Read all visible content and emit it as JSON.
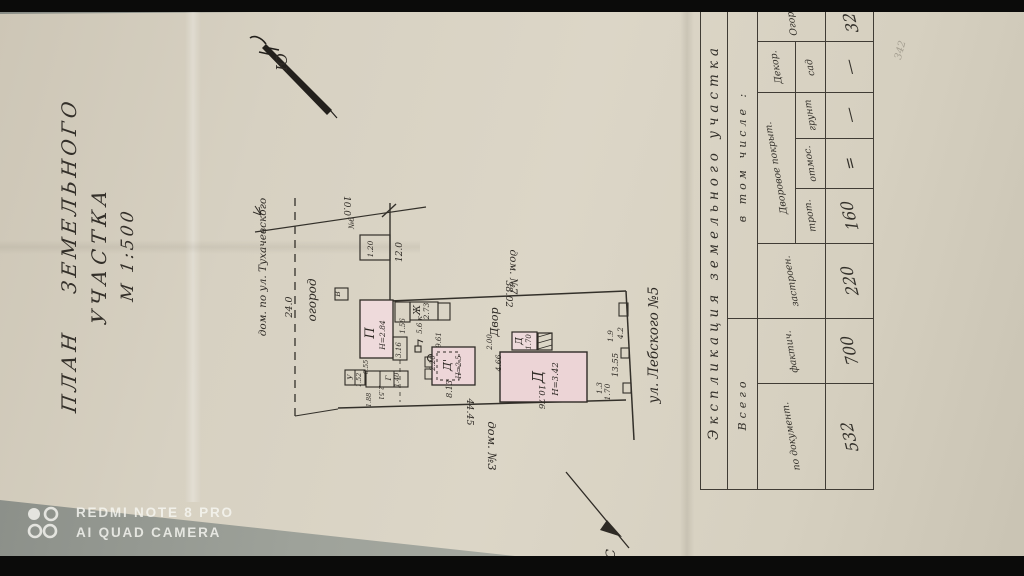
{
  "photo": {
    "watermark": {
      "line1": "REDMI NOTE 8 PRO",
      "line2": "AI QUAD CAMERA"
    }
  },
  "document": {
    "title": {
      "line1": "ПЛАН  ЗЕМЕЛЬНОГО",
      "line2": "УЧАСТКА",
      "line3": "М 1:500"
    },
    "plan": {
      "compass_south": "Ю",
      "compass_north": "С",
      "label_tukhachevsky": "дом. по ул. Тухачевского",
      "label_garden": "огород",
      "label_yard": "Двор",
      "label_house7": "дом. №7",
      "label_house3": "дом. №3",
      "label_street": "ул. Лебского №5",
      "dim_24": "24.0",
      "dim_10": "10.0",
      "dim_12": "12.0",
      "dim_gate": "1.20",
      "gate_no": "№6",
      "dim_38": "38.02",
      "dim_44": "44.45",
      "dim_13_55": "13.55",
      "dim_4_2": "4.2",
      "dim_1_9": "1.9",
      "dim_1_3": "1.3",
      "dim_1_70": "1.70",
      "dim_8_13": "8.13",
      "dim_9_61": "9.61",
      "dim_4_66": "4.66",
      "dim_2_00": "2.00",
      "dim_10_76": "10.76",
      "dim_1_56": "1.56",
      "dim_5_6": "5.6 к",
      "dim_3_16": "3.16",
      "dim_2_20": "2.20",
      "dim_0_55": "0.55",
      "dim_2_51": "2.51",
      "dim_1_52": "1.52",
      "dim_1_40": "1.40",
      "dim_1_88": "1.88",
      "b_p": "П",
      "b_p_h": "Н=2.84",
      "b_zh": "Ж",
      "b_zh_a": "2.73",
      "b_d1": "Д'",
      "b_d1_h": "Н=2.5",
      "b_d": "Д",
      "b_d_h": "Н=3.42",
      "b_d2": "Д",
      "b_d2_a": "1.70",
      "b_u": "У",
      "b_g": "Г",
      "b_v": "В"
    },
    "table": {
      "title": "Экспликация  земельного  участка",
      "group_total": "Всего",
      "group_incl": "в том числе :",
      "col_docs": "по документ.",
      "col_fact": "фактич.",
      "col_built": "застроен.",
      "group_yard": "Дворовое покрыт.",
      "col_trot": "трот.",
      "col_otmos": "отмос.",
      "col_grunt": "грунт",
      "group_decor": "Декор.",
      "col_sad": "сад",
      "col_ogorod": "Огород",
      "values": {
        "docs": "532",
        "fact": "700",
        "built": "220",
        "trot": "160",
        "otmos": "=",
        "grunt": "—",
        "sad": "—",
        "ogorod": "320"
      }
    },
    "stamp": {
      "line1": "Поточні зміни зроблено",
      "line2": "20 04 2012"
    },
    "pencil_note": "342"
  }
}
